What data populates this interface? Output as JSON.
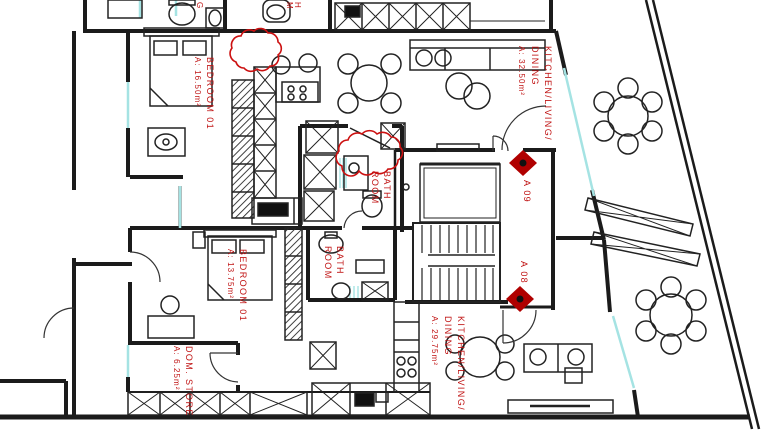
{
  "plan": {
    "rooms": {
      "bedroomA09": {
        "name": "BEDROOM 01",
        "area": "A: 16.50m²"
      },
      "kitchenA09": {
        "name1": "KITCHEN/LIVING/",
        "name2": "DINING",
        "area": "A: 32.50m²"
      },
      "bathA09": {
        "name1": "BATH",
        "name2": "ROOM"
      },
      "bathA08": {
        "name1": "BATH",
        "name2": "ROOM"
      },
      "bedroomA08": {
        "name": "BEDROOM 01",
        "area": "A: 13.75m²"
      },
      "domStore": {
        "name": "DOM. STORE",
        "area": "A: 6.25m²"
      },
      "kitchenA08": {
        "name1": "KITCHEN/LIVING/",
        "name2": "DINING",
        "area": "A: 29.75m²"
      }
    },
    "units": {
      "a09": {
        "label": "A 09"
      },
      "a08": {
        "label": "A 08"
      }
    },
    "fragments": {
      "f1": "G",
      "f2": "M",
      "f3": "H"
    },
    "colors": {
      "wall": "#1b1b1b",
      "label_red": "#c01414",
      "marker_red": "#b00000",
      "glazing_cyan": "#a5e3e3",
      "cloud_red": "#cc1111",
      "paper": "#ffffff"
    }
  }
}
